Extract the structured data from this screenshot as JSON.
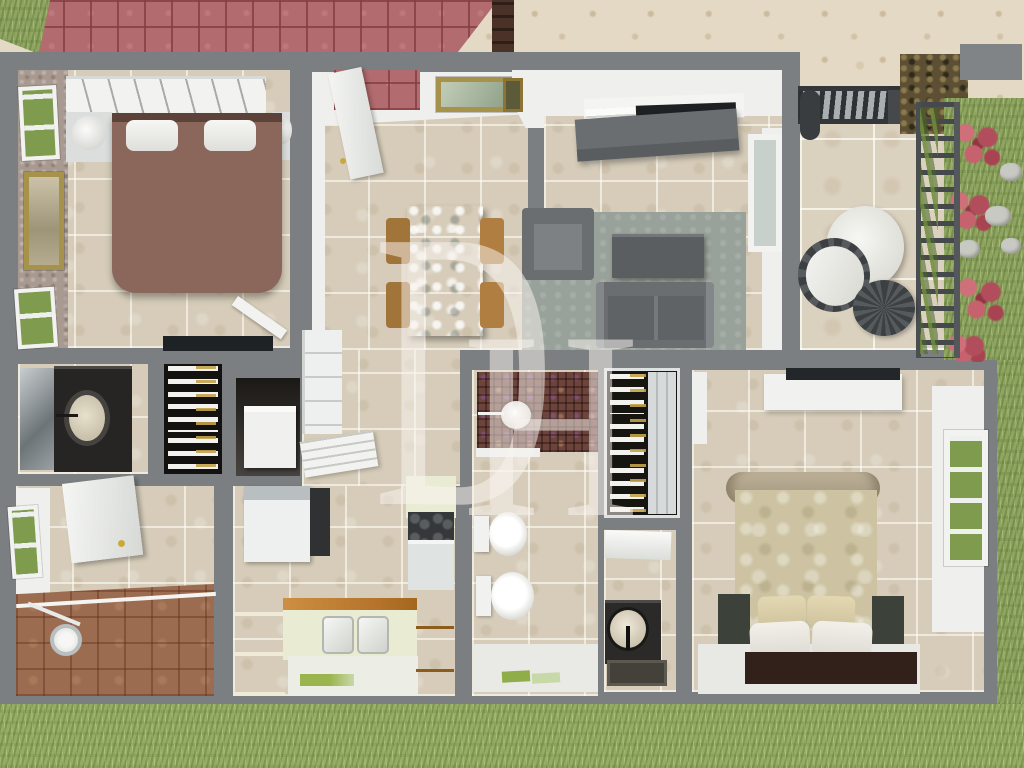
{
  "watermark": {
    "letter_d": "D",
    "letter_h": "H"
  },
  "palette": {
    "wall": "#7b7f81",
    "tile": "#d6ccb9",
    "ground": "#e3d9c5",
    "grass": "#8ea45f",
    "roof": "#b26b6e",
    "wood": "#bd7c31",
    "sofa": "#6a6e71",
    "rug": "#99a29a",
    "bed1": "#8a675a",
    "duvet": "#cdc3a3",
    "mosaic": "#6d443c",
    "watermark": "rgba(250,243,240,0.52)"
  },
  "scene": {
    "type": "3d-floorplan-top-view",
    "rooms": [
      "bedroom-1",
      "dining-room",
      "living-room",
      "patio",
      "bathroom-1",
      "closet-1",
      "storage-alcove",
      "hallway",
      "utility-room",
      "kitchen",
      "master-bathroom",
      "closet-2",
      "wc",
      "master-bedroom"
    ],
    "exterior": [
      "roof-top-left",
      "stone-ground",
      "garden-with-flowers",
      "lawn"
    ]
  }
}
